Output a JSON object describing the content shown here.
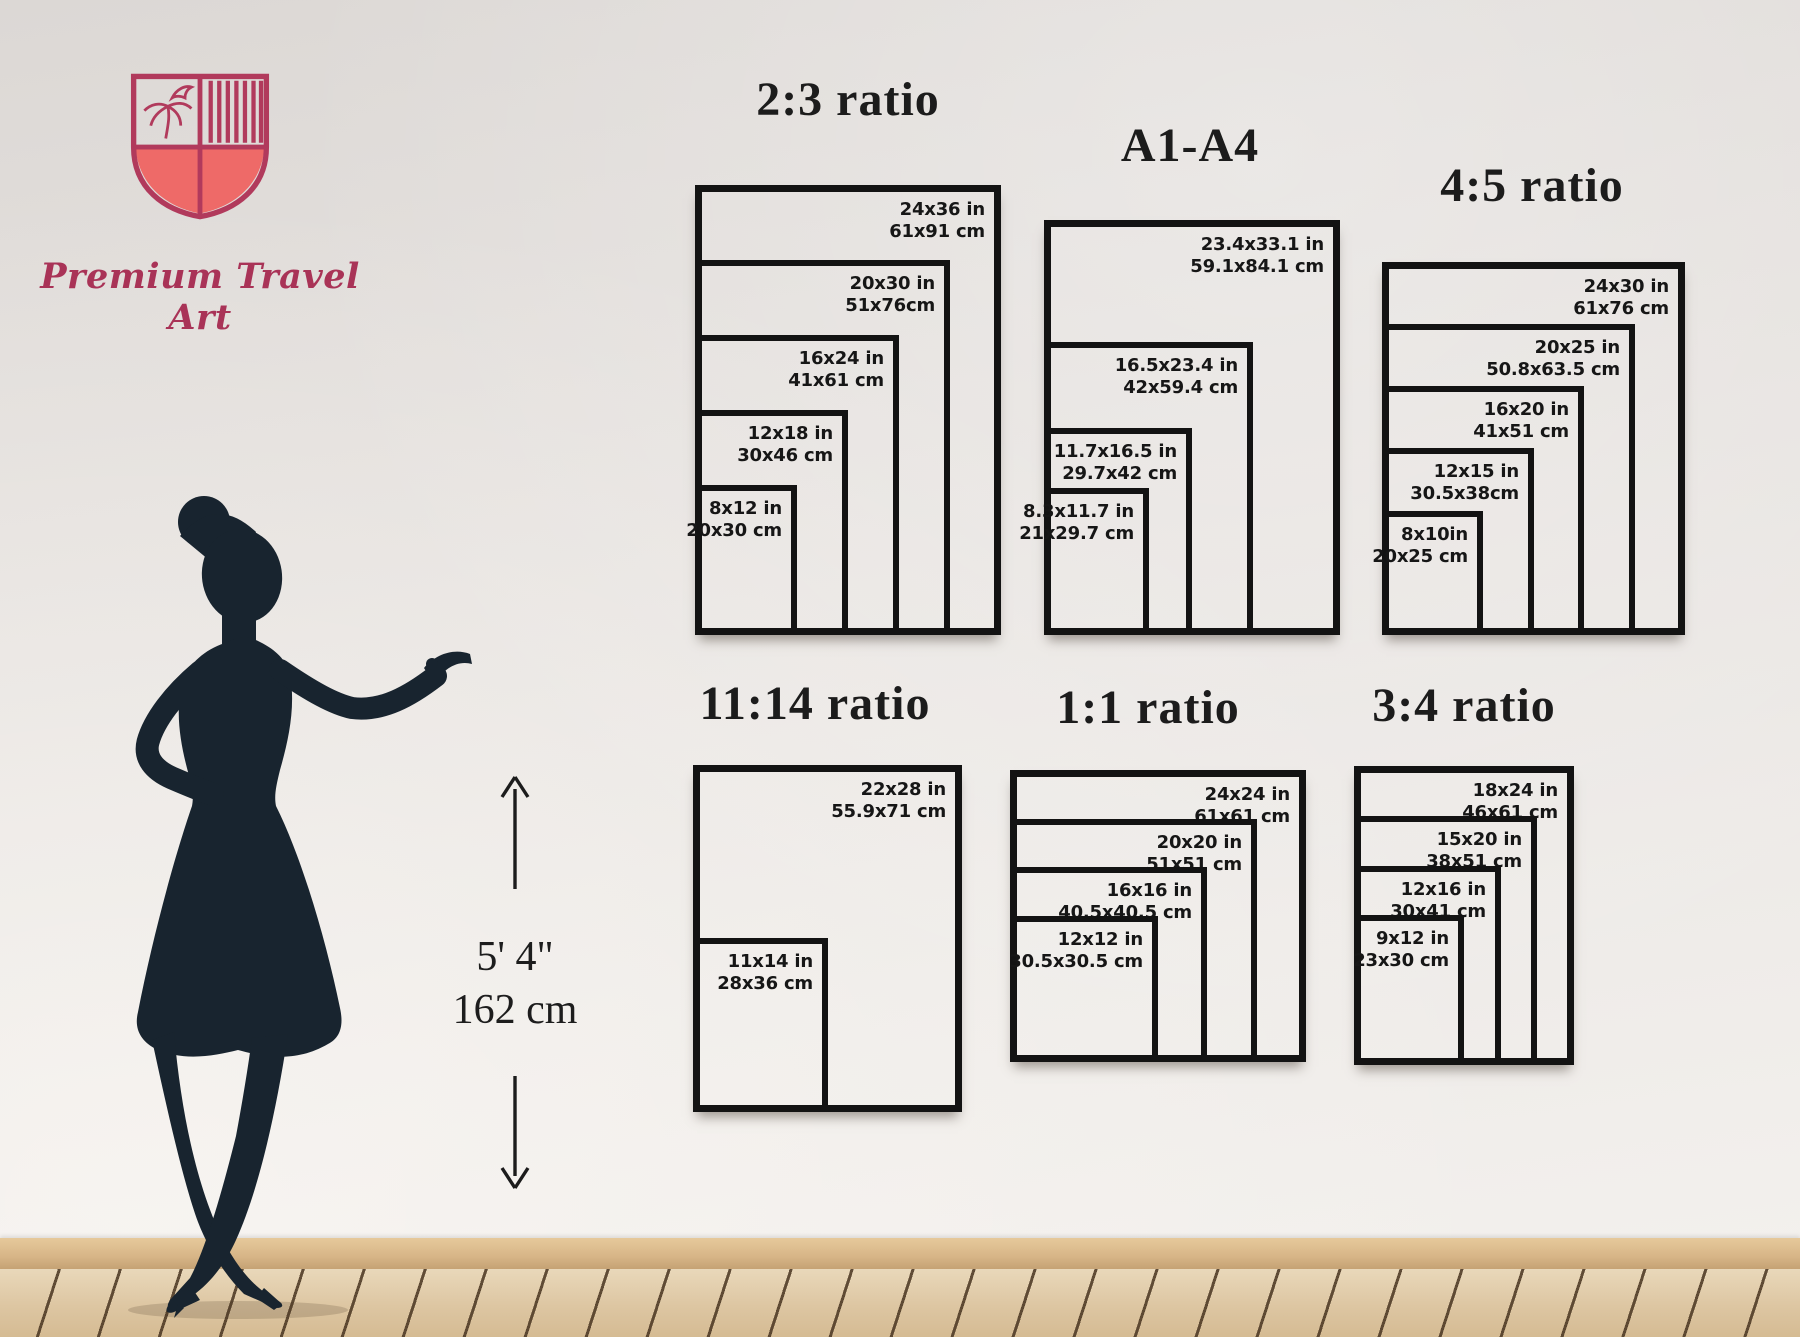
{
  "brand": {
    "name": "Premium Travel Art",
    "logo_colors": {
      "outline": "#b13a5c",
      "fill": "#ee6a68",
      "text": "#a93357"
    }
  },
  "height_marker": {
    "feet": "5' 4\"",
    "cm": "162 cm"
  },
  "palette": {
    "frame": "#131313",
    "wall": "#e8e4e1",
    "floor": "#ddc6a2",
    "silhouette": "#18242f"
  },
  "groups": [
    {
      "id": "ratio-2-3",
      "title": "2:3 ratio",
      "sizes": [
        {
          "w": 24,
          "h": 36,
          "in": "24x36 in",
          "cm": "61x91 cm"
        },
        {
          "w": 20,
          "h": 30,
          "in": "20x30 in",
          "cm": "51x76cm"
        },
        {
          "w": 16,
          "h": 24,
          "in": "16x24 in",
          "cm": "41x61 cm"
        },
        {
          "w": 12,
          "h": 18,
          "in": "12x18 in",
          "cm": "30x46 cm"
        },
        {
          "w": 8,
          "h": 12,
          "in": "8x12 in",
          "cm": "20x30 cm"
        }
      ]
    },
    {
      "id": "a1-a4",
      "title": "A1-A4",
      "sizes": [
        {
          "w": 23.4,
          "h": 33.1,
          "in": "23.4x33.1 in",
          "cm": "59.1x84.1 cm"
        },
        {
          "w": 16.5,
          "h": 23.4,
          "in": "16.5x23.4 in",
          "cm": "42x59.4 cm"
        },
        {
          "w": 11.7,
          "h": 16.5,
          "in": "11.7x16.5 in",
          "cm": "29.7x42 cm"
        },
        {
          "w": 8.3,
          "h": 11.7,
          "in": "8.3x11.7 in",
          "cm": "21x29.7 cm"
        }
      ]
    },
    {
      "id": "ratio-4-5",
      "title": "4:5 ratio",
      "sizes": [
        {
          "w": 24,
          "h": 30,
          "in": "24x30 in",
          "cm": "61x76 cm"
        },
        {
          "w": 20,
          "h": 25,
          "in": "20x25 in",
          "cm": "50.8x63.5 cm"
        },
        {
          "w": 16,
          "h": 20,
          "in": "16x20 in",
          "cm": "41x51 cm"
        },
        {
          "w": 12,
          "h": 15,
          "in": "12x15 in",
          "cm": "30.5x38cm"
        },
        {
          "w": 8,
          "h": 10,
          "in": "8x10in",
          "cm": "20x25 cm"
        }
      ]
    },
    {
      "id": "ratio-11-14",
      "title": "11:14 ratio",
      "sizes": [
        {
          "w": 22,
          "h": 28,
          "in": "22x28 in",
          "cm": "55.9x71 cm"
        },
        {
          "w": 11,
          "h": 14,
          "in": "11x14 in",
          "cm": "28x36 cm"
        }
      ]
    },
    {
      "id": "ratio-1-1",
      "title": "1:1 ratio",
      "sizes": [
        {
          "w": 24,
          "h": 24,
          "in": "24x24 in",
          "cm": "61x61 cm"
        },
        {
          "w": 20,
          "h": 20,
          "in": "20x20 in",
          "cm": "51x51 cm"
        },
        {
          "w": 16,
          "h": 16,
          "in": "16x16 in",
          "cm": "40.5x40.5 cm"
        },
        {
          "w": 12,
          "h": 12,
          "in": "12x12 in",
          "cm": "30.5x30.5 cm"
        }
      ]
    },
    {
      "id": "ratio-3-4",
      "title": "3:4 ratio",
      "sizes": [
        {
          "w": 18,
          "h": 24,
          "in": "18x24 in",
          "cm": "46x61 cm"
        },
        {
          "w": 15,
          "h": 20,
          "in": "15x20 in",
          "cm": "38x51 cm"
        },
        {
          "w": 12,
          "h": 16,
          "in": "12x16 in",
          "cm": "30x41 cm"
        },
        {
          "w": 9,
          "h": 12,
          "in": "9x12 in",
          "cm": "23x30 cm"
        }
      ]
    }
  ]
}
